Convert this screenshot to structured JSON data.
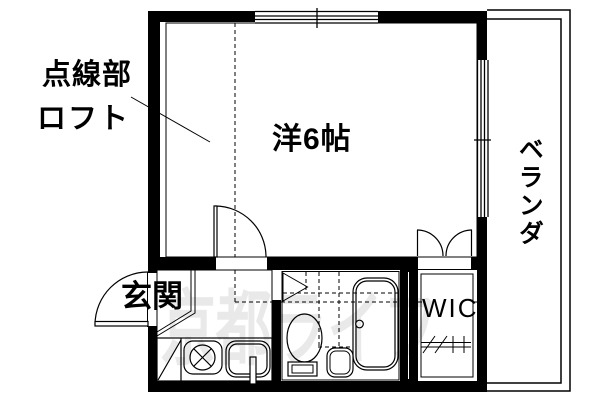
{
  "labels": {
    "loft_note_line1": "点線部",
    "loft_note_line2": "ロフト",
    "main_room": "洋6帖",
    "balcony": "ベランダ",
    "entrance": "玄関",
    "walk_in_closet": "WIC"
  },
  "watermark_text": "京都ライフ",
  "colors": {
    "line": "#000000",
    "background": "#ffffff",
    "watermark_gray": "#e8e8e8"
  }
}
